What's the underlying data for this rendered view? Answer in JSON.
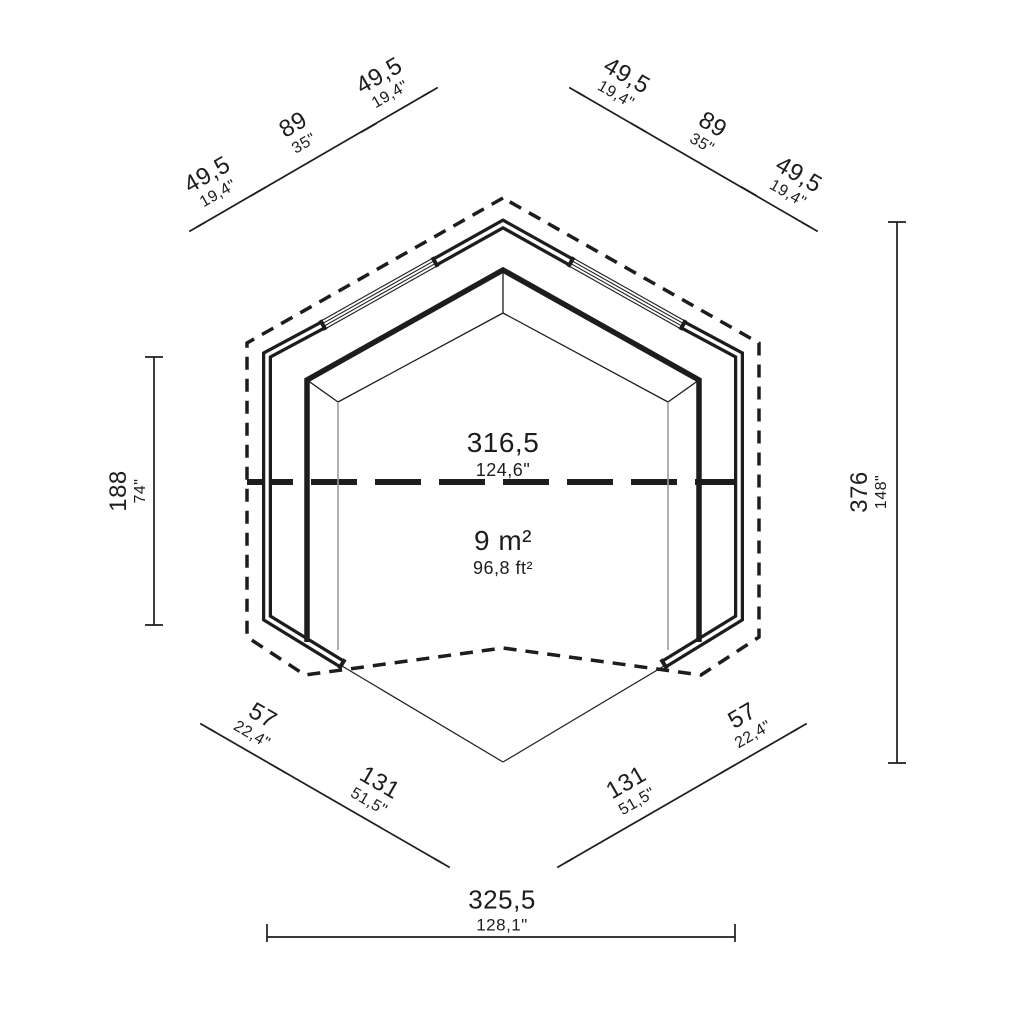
{
  "drawing_type": "floor-plan",
  "colors": {
    "line": "#1d1d1b",
    "floor_line": "#9b9b9b",
    "background": "#ffffff"
  },
  "dims": {
    "top_left": {
      "segments": [
        {
          "cm": "49,5",
          "in": "19,4\""
        },
        {
          "cm": "89",
          "in": "35\""
        },
        {
          "cm": "49,5",
          "in": "19,4\""
        }
      ]
    },
    "top_right": {
      "segments": [
        {
          "cm": "49,5",
          "in": "19,4\""
        },
        {
          "cm": "89",
          "in": "35\""
        },
        {
          "cm": "49,5",
          "in": "19,4\""
        }
      ]
    },
    "left": {
      "cm": "188",
      "in": "74\""
    },
    "right": {
      "cm": "376",
      "in": "148\""
    },
    "bottom_left": {
      "segments": [
        {
          "cm": "57",
          "in": "22,4\""
        },
        {
          "cm": "131",
          "in": "51,5\""
        }
      ]
    },
    "bottom_right": {
      "segments": [
        {
          "cm": "131",
          "in": "51,5\""
        },
        {
          "cm": "57",
          "in": "22,4\""
        }
      ]
    },
    "bottom": {
      "cm": "325,5",
      "in": "128,1\""
    },
    "interior_width": {
      "cm": "316,5",
      "in": "124,6\""
    },
    "area": {
      "metric": "9 m²",
      "imperial": "96,8 ft²"
    }
  }
}
